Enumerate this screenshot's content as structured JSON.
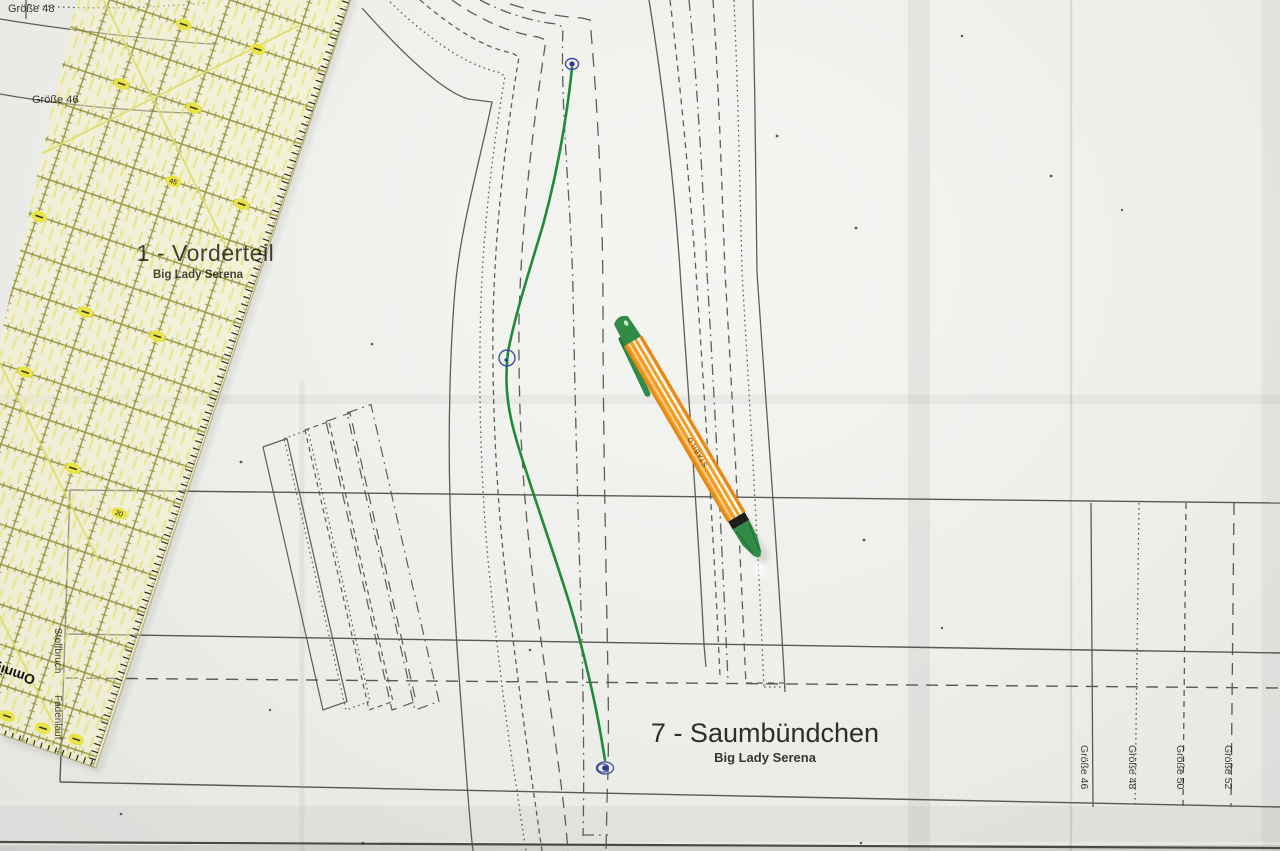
{
  "labels": {
    "size_48_top": "Größe 48",
    "size_46_top": "Größe 46",
    "front_piece_title": "1 - Vorderteil",
    "front_piece_subtitle": "Big Lady Serena",
    "hem_piece_title": "7 - Saumbündchen",
    "hem_piece_subtitle": "Big Lady Serena",
    "fold_line": "Stoffbruch",
    "grain_line": "Fadenlauf"
  },
  "size_lines": [
    {
      "label": "Größe 46",
      "style": "solid"
    },
    {
      "label": "Größe 48",
      "style": "dotted"
    },
    {
      "label": "Größe 50",
      "style": "dashed"
    },
    {
      "label": "Größe 52",
      "style": "long-dash"
    }
  ],
  "ruler": {
    "brand": "Omnigrid",
    "scale_numbers": [
      "45",
      "20"
    ],
    "body_tint": "#f7f3c2",
    "grid_color": "#7d7a10",
    "pill_color": "#e9e346"
  },
  "pen": {
    "barrel_text": "STABILO",
    "barrel_color": "#f59b20",
    "cap_color": "#2f8b45"
  },
  "annotation": {
    "line_color": "#1f8a3a",
    "dot_color": "#3b4da0"
  }
}
